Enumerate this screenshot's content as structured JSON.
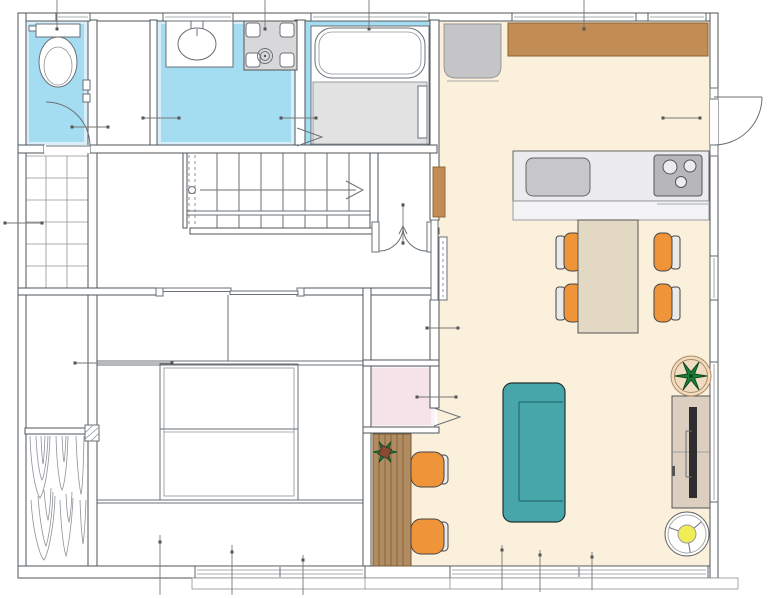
{
  "palette": {
    "wall-line": "#4f555b",
    "fixture-line": "#6a7076",
    "grid-line": "#8d9399",
    "water-blue": "#a4dcf2",
    "water-blue-light": "#d8effa",
    "ldk-cream": "#faf0dc",
    "counter-brown": "#c18d55",
    "counter-brown-edge": "#8a6434",
    "wood-counter": "#b18c61",
    "wood-counter-edge": "#77593a",
    "pink-room": "#f6e2e9",
    "pink-room-light": "#fbf2f6",
    "appliance-gray": "#d8d8da",
    "fridge-gray": "#c5c5c7",
    "counter-gray": "#ececee",
    "counter-gray-2": "#f4f4f6",
    "sink-gray": "#c7c7c9",
    "stove-gray": "#b7b7b9",
    "shower-gray": "#e2e2e2",
    "table-beige": "#e3d8c4",
    "chair-orange": "#f0943a",
    "chair-back-gray": "#eaeaea",
    "sofa-teal": "#47a6aa",
    "tv-board-beige": "#dccfc0",
    "tv-black": "#2e2e2e",
    "lamp-yellow": "#f1ed56",
    "plant-green": "#1f7d35",
    "plant-green-dark": "#0d4a1c",
    "plant-pot-tan": "#efdcc2",
    "plant-pot-brown": "#8a4a2e"
  },
  "rooms": [
    {
      "id": "toilet-room",
      "floor": "water-blue"
    },
    {
      "id": "hall-closet",
      "floor": "white"
    },
    {
      "id": "washroom",
      "floor": "water-blue"
    },
    {
      "id": "bathroom",
      "floor": "white-with-blue-border"
    },
    {
      "id": "ldk",
      "floor": "cream"
    },
    {
      "id": "entrance-tiled-floor",
      "floor": "white-tile-grid"
    },
    {
      "id": "stair-hall",
      "floor": "white"
    },
    {
      "id": "japanese-room",
      "floor": "white"
    },
    {
      "id": "pink-nook",
      "floor": "pink"
    },
    {
      "id": "wood-deck",
      "floor": "wood-grain"
    }
  ],
  "fixtures": [
    {
      "name": "toilet"
    },
    {
      "name": "wash-basin"
    },
    {
      "name": "washing-machine"
    },
    {
      "name": "bathtub"
    },
    {
      "name": "shower-floor"
    },
    {
      "name": "refrigerator"
    },
    {
      "name": "kitchen-counter-with-sink-and-stove"
    },
    {
      "name": "wall-counter-brown"
    },
    {
      "name": "wall-cabinet"
    },
    {
      "name": "staircase",
      "steps_visible": 8
    }
  ],
  "furniture": [
    {
      "name": "dining-table",
      "chairs": 4
    },
    {
      "name": "sofa"
    },
    {
      "name": "tv-board-with-tv"
    },
    {
      "name": "floor-lamp"
    },
    {
      "name": "potted-plant-large"
    },
    {
      "name": "potted-plant-small"
    },
    {
      "name": "counter-desk",
      "stools": 2
    }
  ],
  "openings": [
    {
      "name": "toilet-swing-door"
    },
    {
      "name": "bathroom-folding-door"
    },
    {
      "name": "hall-double-swing-door"
    },
    {
      "name": "ldk-sliding-door"
    },
    {
      "name": "nook-folding-door"
    },
    {
      "name": "ldk-entry-swing-door"
    },
    {
      "name": "japanese-room-sliding-doors"
    },
    {
      "name": "veranda-strip"
    }
  ]
}
